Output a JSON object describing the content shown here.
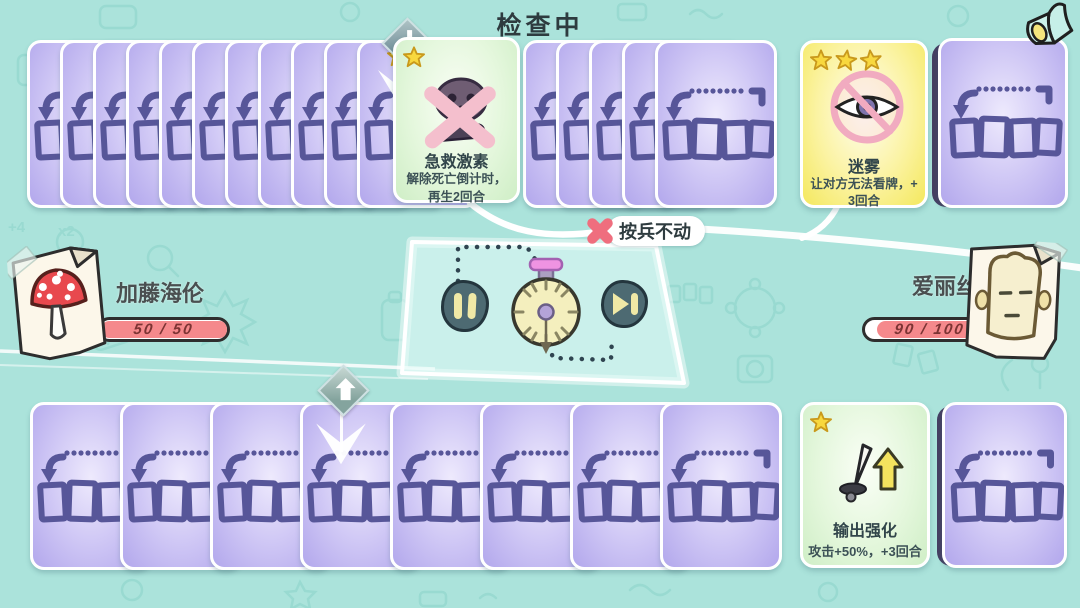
{
  "page": {
    "title": "检查中"
  },
  "status": {
    "label": "按兵不动",
    "icon": "cross-x"
  },
  "players": {
    "opponent": {
      "name": "加藤海伦",
      "avatar": "mushroom",
      "hp_current": 50,
      "hp_max": 50,
      "hp_text": "50 / 50",
      "hp_percent": 100
    },
    "self": {
      "name": "爱丽丝",
      "avatar": "toast",
      "hp_current": 90,
      "hp_max": 100,
      "hp_text": "90 / 100",
      "hp_percent": 90
    }
  },
  "cards": {
    "first_aid": {
      "stars": 1,
      "title": "急救激素",
      "desc_lines": [
        "解除死亡倒计时，",
        "再生2回合"
      ],
      "icon": "skull-crossed"
    },
    "mist": {
      "stars": 3,
      "title": "迷雾",
      "desc_lines": [
        "让对方无法看牌，+",
        "3回合"
      ],
      "icon": "eye-banned"
    },
    "attack_boost": {
      "stars": 1,
      "title": "输出强化",
      "desc_lines": [
        "攻击+50%，+3回合"
      ],
      "icon": "dagger-up-arrow"
    }
  },
  "rows": {
    "top": {
      "facedown_before": 11,
      "facedown_after": 4,
      "full": 1
    },
    "bottom": {
      "facedown": 7,
      "full": 1
    }
  },
  "icons": {
    "horn-icon": "megaphone horn",
    "pause-icon": "two vertical bars",
    "skip-icon": "play triangle with bar",
    "stopwatch-icon": "round timer with pink cap",
    "card-back-icon": "arrow with dotted line over 4 card slots"
  },
  "colors": {
    "background": "#abe3db",
    "card_purple": "#b2a7ec",
    "card_green": "#d9f3d0",
    "card_yellow": "#f5e95f",
    "hp_fill": "#f5898c",
    "button_dark": "#4d6a72",
    "button_glyph": "#f0e9a6",
    "cross_red": "#ef6e7e",
    "star_yellow": "#f8d83e"
  }
}
